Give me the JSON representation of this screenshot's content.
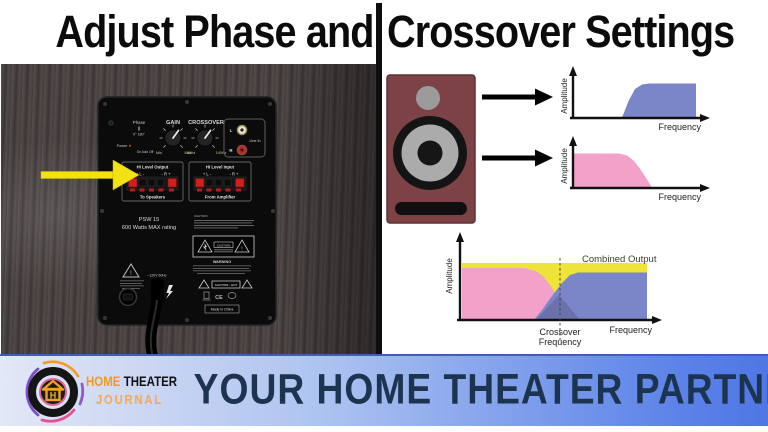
{
  "title": {
    "left": "Adjust Phase and",
    "right": "Crossover Settings"
  },
  "amp_panel": {
    "phase": {
      "label": "Phase",
      "positions": "0°   180°"
    },
    "power": {
      "label": "Power",
      "modes": "On  Auto  Off"
    },
    "gain": {
      "label": "GAIN",
      "min": "Min",
      "max": "Max"
    },
    "crossover": {
      "label": "CROSSOVER",
      "min": "40Hz",
      "max": "140Hz"
    },
    "line_in": {
      "left": "L",
      "right": "R",
      "label": "Line In"
    },
    "hi_level_output": {
      "title": "Hi Level Output",
      "left_terminal": "+ L -",
      "right_terminal": "- R +",
      "caption": "To Speakers"
    },
    "hi_level_input": {
      "title": "Hi Level Input",
      "left_terminal": "+ L -",
      "right_terminal": "- R +",
      "caption": "From Amplifier"
    },
    "model": "PSW 15",
    "rating": "600 Watts MAX rating",
    "caution_heading": "CAUTION",
    "caution_label": "CAUTION",
    "warning_heading": "WARNING",
    "caution_hot": "CAUTION - HOT",
    "power_spec": "~120V 60Hz",
    "made_in": "Made in China",
    "ce_mark": "CE",
    "exclamation": "!"
  },
  "diagrams": {
    "axis": {
      "amplitude": "Amplitude",
      "frequency": "Frequency"
    },
    "combined": {
      "label": "Combined Output",
      "crossover_word1": "Crossover",
      "crossover_word2": "Frequency"
    }
  },
  "chart_data": [
    {
      "type": "area",
      "name": "High-pass (main speakers) response",
      "color": "#7b86c8",
      "xlabel": "Frequency",
      "ylabel": "Amplitude",
      "x_range": [
        0,
        1
      ],
      "y_range": [
        0,
        1
      ],
      "grid": false,
      "points": [
        [
          0,
          0
        ],
        [
          0.38,
          0
        ],
        [
          0.45,
          0.55
        ],
        [
          0.5,
          0.85
        ],
        [
          0.57,
          1
        ],
        [
          0.93,
          1
        ],
        [
          0.93,
          0
        ]
      ]
    },
    {
      "type": "area",
      "name": "Low-pass (subwoofer) response",
      "color": "#f2a2c8",
      "xlabel": "Frequency",
      "ylabel": "Amplitude",
      "x_range": [
        0,
        1
      ],
      "y_range": [
        0,
        1
      ],
      "grid": false,
      "points": [
        [
          0,
          1
        ],
        [
          0.34,
          1
        ],
        [
          0.42,
          0.85
        ],
        [
          0.5,
          0.45
        ],
        [
          0.58,
          0
        ]
      ]
    },
    {
      "type": "area",
      "name": "Combined crossover response",
      "xlabel": "Frequency",
      "ylabel": "Amplitude",
      "grid": false,
      "crossover_frequency_x": 0.53,
      "annotations": [
        "Combined Output",
        "Crossover Frequency"
      ],
      "series": [
        {
          "name": "Combined Output",
          "color": "#eee338",
          "points": [
            [
              0,
              1
            ],
            [
              1,
              1
            ]
          ]
        },
        {
          "name": "Low-pass (subwoofer)",
          "color": "#f2a2c8",
          "points": [
            [
              0,
              0.92
            ],
            [
              0.33,
              0.92
            ],
            [
              0.45,
              0.62
            ],
            [
              0.53,
              0.32
            ],
            [
              0.59,
              0
            ]
          ]
        },
        {
          "name": "High-pass (speakers)",
          "color": "#7b86c8",
          "points": [
            [
              0.39,
              0
            ],
            [
              0.47,
              0.35
            ],
            [
              0.57,
              0.75
            ],
            [
              0.63,
              0.84
            ],
            [
              1,
              0.84
            ]
          ]
        }
      ]
    }
  ],
  "banner": {
    "logo": {
      "line1_part1": "HOME",
      "line1_part2": "THEATER",
      "line2": "JOURNAL"
    },
    "slogan": "YOUR HOME THEATER PARTNER"
  }
}
